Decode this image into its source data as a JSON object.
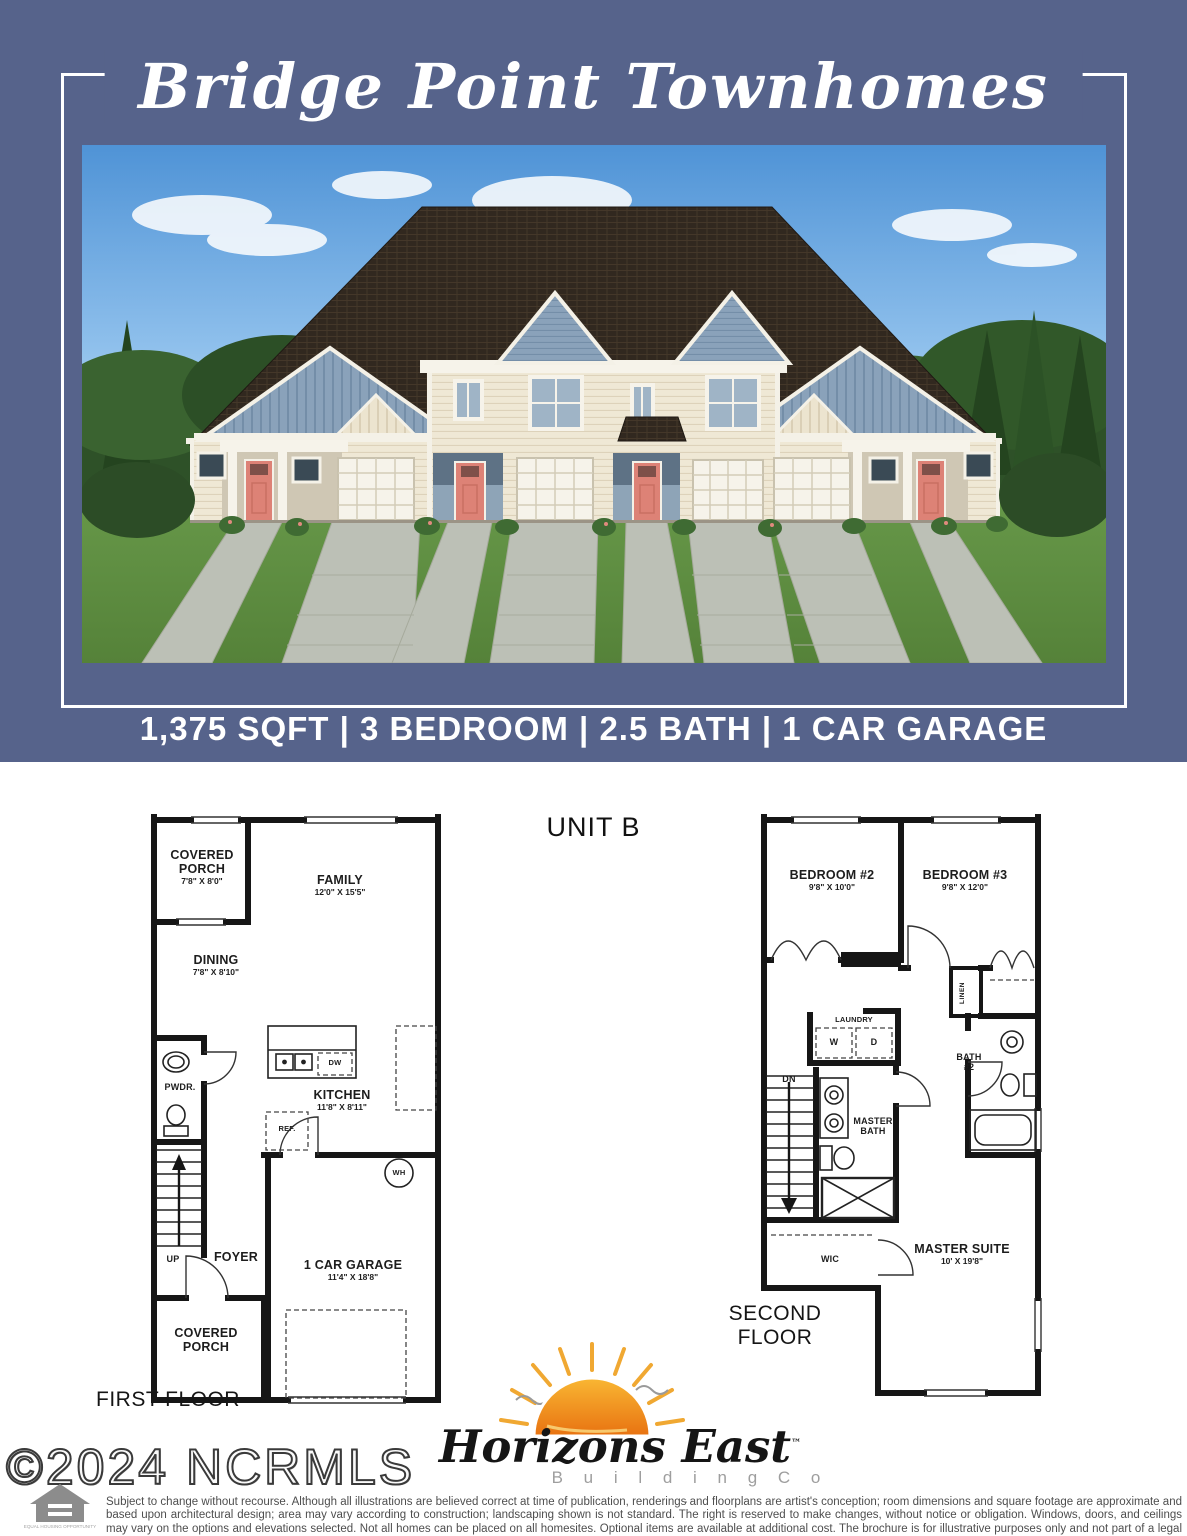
{
  "header": {
    "title": "Bridge Point Townhomes",
    "specs": "1,375 SQFT | 3 BEDROOM | 2.5 BATH | 1 CAR GARAGE"
  },
  "unit_label": "UNIT B",
  "colors": {
    "panel_blue": "#56638b",
    "door_coral": "#dd8276",
    "sun_orange": "#f29111",
    "roof_brown": "#31281f"
  },
  "first_floor": {
    "caption": "FIRST FLOOR",
    "covered_porch": {
      "name": "COVERED PORCH",
      "dims": "7'8\" X 8'0\""
    },
    "family": {
      "name": "FAMILY",
      "dims": "12'0\" X 15'5\""
    },
    "dining": {
      "name": "DINING",
      "dims": "7'8\" X 8'10\""
    },
    "pwdr": "PWDR.",
    "kitchen": {
      "name": "KITCHEN",
      "dims": "11'8\" X 8'11\""
    },
    "ref": "REF.",
    "dw": "DW",
    "wh": "WH",
    "up": "UP",
    "foyer": "FOYER",
    "garage": {
      "name": "1 CAR GARAGE",
      "dims": "11'4\" X 18'8\""
    },
    "covered_porch_rear": "COVERED PORCH"
  },
  "second_floor": {
    "caption": "SECOND FLOOR",
    "bedroom2": {
      "name": "BEDROOM #2",
      "dims": "9'8\" X 10'0\""
    },
    "bedroom3": {
      "name": "BEDROOM #3",
      "dims": "9'8\" X 12'0\""
    },
    "linen": "LINEN",
    "laundry": "LAUNDRY",
    "washer": "W",
    "dryer": "D",
    "bath2": "BATH #2",
    "dn": "DN",
    "master_bath": "MASTER BATH",
    "wic": "WIC",
    "master_suite": {
      "name": "MASTER SUITE",
      "dims": "10' X 19'8\""
    }
  },
  "logo": {
    "name": "Horizons East",
    "tm": "™",
    "subtitle": "B u i l d i n g   C o ."
  },
  "footer": {
    "copyright": "©2024 NCRMLS",
    "equal_housing": "EQUAL HOUSING OPPORTUNITY",
    "disclaimer": "Subject to change without recourse. Although all illustrations are believed correct at time of publication, renderings and floorplans are artist's conception; room dimensions and square footage are approximate and based upon architectural design; area may vary according to construction; landscaping shown is not standard. The right is reserved to make changes, without notice or obligation. Windows, doors, and ceilings may vary on the options and elevations selected. Not all homes can be placed on all homesites. Optional items are available at additional cost. The brochure is for illustrative purposes only and not part of a legal contract. Please see sales consultant for further details."
  }
}
